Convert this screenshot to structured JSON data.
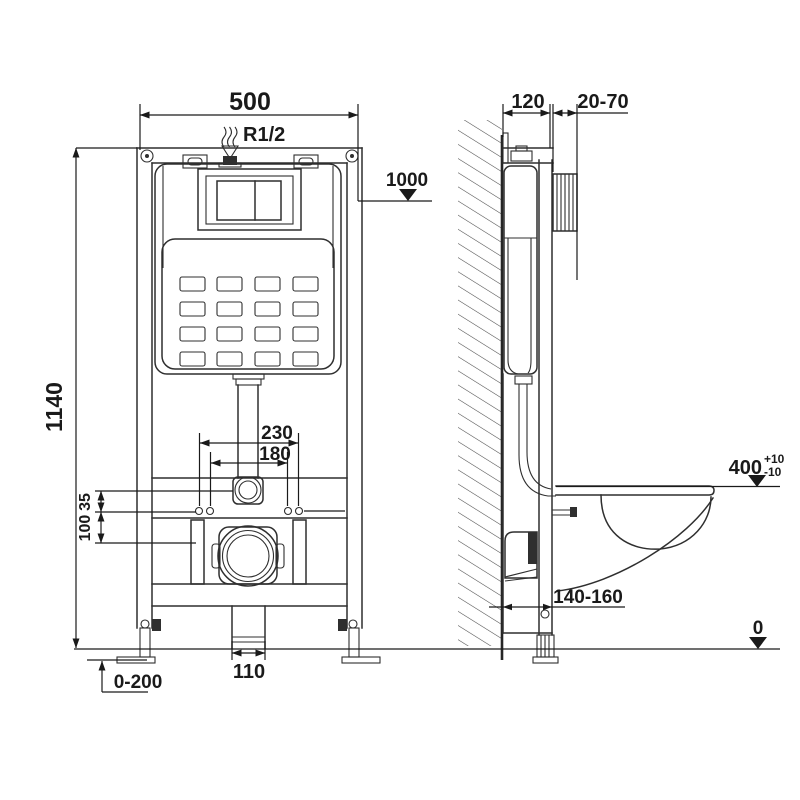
{
  "drawing": {
    "title": "wall-hung-wc-frame-installation-diagram",
    "background": "#ffffff",
    "line_color": "#2f2f2f",
    "views": {
      "front": "frame front view with concealed cistern",
      "side": "frame side view on wall with wc bowl profile"
    },
    "labels": {
      "front_width": "500",
      "inlet_thread": "R1/2",
      "frame_height": "1140",
      "actuator_level": "1000",
      "bolt_spacing_outer": "230",
      "bolt_spacing_inner": "180",
      "inlet_to_holes": "35",
      "holes_to_drain": "100",
      "drain_pipe_width": "110",
      "foot_adjustment": "0-200",
      "frame_depth": "120",
      "panel_range": "20-70",
      "bowl_level": "400",
      "bowl_level_tol_plus": "+10",
      "bowl_level_tol_minus": "-10",
      "drain_outlet_range": "140-160",
      "floor_level": "0"
    }
  }
}
